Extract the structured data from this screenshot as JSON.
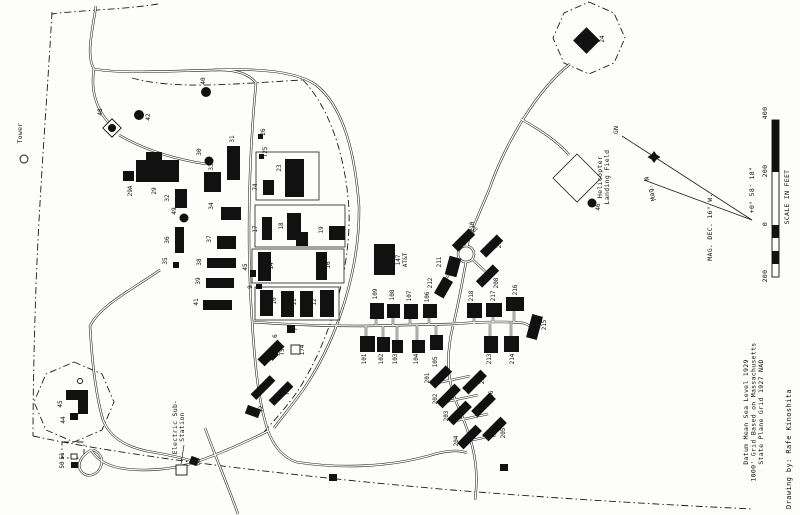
{
  "map": {
    "tower_label": "Tower",
    "att": {
      "number": "147",
      "name": "AT&T"
    },
    "helicopter": {
      "line1": "Helicopter",
      "line2": "Landing Field"
    },
    "substation": {
      "line1": "Electric Sub-",
      "line2": "Station"
    },
    "compass": {
      "grid_north": "GN",
      "magnetic_north": "Mag. N",
      "declination": "MAG. DEC. 16° W.",
      "grid_offset": "+0° 58' 18\""
    },
    "scale_bar": {
      "ticks": [
        "400",
        "200",
        "0",
        "200"
      ],
      "caption": "SCALE IN FEET"
    },
    "notes": {
      "datum1": "Datum Mean Sea Level 1929",
      "datum2": "1000' Grid Based on Massachusetts",
      "datum3": "State Plane Grid 1927 NAD",
      "credit": "Drawing by: Rafe Kinoshita"
    },
    "buildings": [
      {
        "n": "",
        "t": "circle",
        "x": 24,
        "y": 159,
        "r": 4
      },
      {
        "n": "40",
        "t": "dot",
        "x": 206,
        "y": 92,
        "r": 5,
        "lx": 205,
        "ly": 81
      },
      {
        "n": "42",
        "t": "dot",
        "x": 139,
        "y": 115,
        "r": 5,
        "lx": 150,
        "ly": 117
      },
      {
        "n": "",
        "t": "open",
        "x": 105.5,
        "y": 121.5,
        "w": 13,
        "h": 13,
        "rot": 45
      },
      {
        "n": "48",
        "t": "dot",
        "x": 112,
        "y": 128,
        "r": 4,
        "lx": 102,
        "ly": 112
      },
      {
        "n": "30",
        "t": "dot",
        "x": 209,
        "y": 161,
        "r": 4.5,
        "lx": 201,
        "ly": 152
      },
      {
        "n": "49",
        "t": "dot",
        "x": 184,
        "y": 218,
        "r": 4.5,
        "lx": 176,
        "ly": 211
      },
      {
        "n": "46",
        "t": "dot",
        "x": 592,
        "y": 203,
        "r": 4.5,
        "lx": 600,
        "ly": 207
      },
      {
        "n": "29A",
        "t": "rect",
        "x": 123,
        "y": 171,
        "w": 11,
        "h": 10,
        "lx": 132,
        "ly": 191
      },
      {
        "n": "",
        "t": "rect",
        "x": 146,
        "y": 152,
        "w": 16,
        "h": 10
      },
      {
        "n": "29",
        "t": "rect",
        "x": 136,
        "y": 160,
        "w": 43,
        "h": 22,
        "lx": 156,
        "ly": 191
      },
      {
        "n": "32",
        "t": "rect",
        "x": 175,
        "y": 189,
        "w": 12,
        "h": 19,
        "lx": 169,
        "ly": 198
      },
      {
        "n": "36",
        "t": "rect",
        "x": 175,
        "y": 227,
        "w": 9,
        "h": 26,
        "lx": 169,
        "ly": 240
      },
      {
        "n": "35",
        "t": "rect",
        "x": 173,
        "y": 262,
        "w": 6,
        "h": 6,
        "lx": 167,
        "ly": 261
      },
      {
        "n": "33",
        "t": "rect",
        "x": 204,
        "y": 172,
        "w": 17,
        "h": 20,
        "lx": 213,
        "ly": 167
      },
      {
        "n": "31",
        "t": "rect",
        "x": 227,
        "y": 146,
        "w": 13,
        "h": 34,
        "lx": 234,
        "ly": 139
      },
      {
        "n": "26",
        "t": "rect",
        "x": 258,
        "y": 134,
        "w": 5,
        "h": 5,
        "lx": 265,
        "ly": 132
      },
      {
        "n": "T25",
        "t": "rect",
        "x": 259,
        "y": 154,
        "w": 5,
        "h": 5,
        "lx": 267,
        "ly": 152
      },
      {
        "n": "74",
        "t": "rect",
        "x": 263,
        "y": 180,
        "w": 11,
        "h": 15,
        "lx": 257,
        "ly": 187
      },
      {
        "n": "23",
        "t": "rect",
        "x": 285,
        "y": 159,
        "w": 19,
        "h": 38,
        "lx": 281,
        "ly": 168
      },
      {
        "n": "34",
        "t": "rect",
        "x": 221,
        "y": 207,
        "w": 20,
        "h": 13,
        "lx": 213,
        "ly": 206
      },
      {
        "n": "37",
        "t": "rect",
        "x": 217,
        "y": 236,
        "w": 19,
        "h": 13,
        "lx": 211,
        "ly": 239
      },
      {
        "n": "38",
        "t": "rect",
        "x": 207,
        "y": 258,
        "w": 29,
        "h": 10,
        "lx": 201,
        "ly": 262
      },
      {
        "n": "39",
        "t": "rect",
        "x": 206,
        "y": 278,
        "w": 28,
        "h": 10,
        "lx": 200,
        "ly": 281
      },
      {
        "n": "41",
        "t": "rect",
        "x": 203,
        "y": 300,
        "w": 29,
        "h": 10,
        "lx": 198,
        "ly": 302
      },
      {
        "n": "17",
        "t": "rect",
        "x": 262,
        "y": 217,
        "w": 10,
        "h": 23,
        "lx": 257,
        "ly": 229
      },
      {
        "n": "",
        "t": "rect",
        "x": 296,
        "y": 232,
        "w": 12,
        "h": 14
      },
      {
        "n": "18",
        "t": "rect",
        "x": 287,
        "y": 213,
        "w": 14,
        "h": 27,
        "lx": 283,
        "ly": 226
      },
      {
        "n": "19",
        "t": "rect",
        "x": 329,
        "y": 226,
        "w": 16,
        "h": 14,
        "lx": 323,
        "ly": 230
      },
      {
        "n": "14",
        "t": "rect",
        "x": 258,
        "y": 252,
        "w": 13,
        "h": 29,
        "lx": 273,
        "ly": 266
      },
      {
        "n": "45",
        "t": "rect",
        "x": 250,
        "y": 270,
        "w": 6,
        "h": 7,
        "lx": 247,
        "ly": 267
      },
      {
        "n": "16",
        "t": "rect",
        "x": 316,
        "y": 252,
        "w": 11,
        "h": 28,
        "lx": 330,
        "ly": 265
      },
      {
        "n": "9",
        "t": "rect",
        "x": 256,
        "y": 284,
        "w": 6,
        "h": 5,
        "lx": 252,
        "ly": 287
      },
      {
        "n": "10",
        "t": "rect",
        "x": 260,
        "y": 290,
        "w": 13,
        "h": 26,
        "lx": 276,
        "ly": 301
      },
      {
        "n": "11",
        "t": "rect",
        "x": 281,
        "y": 291,
        "w": 13,
        "h": 26,
        "lx": 296,
        "ly": 302
      },
      {
        "n": "12",
        "t": "rect",
        "x": 300,
        "y": 291,
        "w": 13,
        "h": 26,
        "lx": 316,
        "ly": 302
      },
      {
        "n": "",
        "t": "rect",
        "x": 320,
        "y": 290,
        "w": 14,
        "h": 27
      },
      {
        "n": "6",
        "t": "rect",
        "x": 266,
        "y": 339,
        "w": 10,
        "h": 28,
        "rot": 45,
        "lx": 277,
        "ly": 336
      },
      {
        "n": "",
        "t": "rect",
        "x": 268,
        "y": 350,
        "w": 9,
        "h": 9,
        "rot": 45
      },
      {
        "n": "T5",
        "t": "label",
        "lx": 284,
        "ly": 352
      },
      {
        "n": "7",
        "t": "rect",
        "x": 287,
        "y": 325,
        "w": 8,
        "h": 8,
        "lx": 297,
        "ly": 329
      },
      {
        "n": "174",
        "t": "open",
        "x": 291,
        "y": 345,
        "w": 9,
        "h": 9,
        "lx": 304,
        "ly": 350
      },
      {
        "n": "T4",
        "t": "rect",
        "x": 259,
        "y": 374,
        "w": 8,
        "h": 27,
        "rot": 45,
        "lx": 269,
        "ly": 383
      },
      {
        "n": "T3",
        "t": "rect",
        "x": 277,
        "y": 380,
        "w": 8,
        "h": 27,
        "rot": 45,
        "lx": 289,
        "ly": 392
      },
      {
        "n": "T2",
        "t": "rect",
        "x": 246,
        "y": 407,
        "w": 14,
        "h": 9,
        "rot": 20,
        "lx": 263,
        "ly": 409
      },
      {
        "n": "",
        "t": "rect",
        "x": 374,
        "y": 244,
        "w": 21,
        "h": 31
      },
      {
        "n": "101",
        "t": "rect",
        "x": 360,
        "y": 336,
        "w": 15,
        "h": 16,
        "lx": 366,
        "ly": 359
      },
      {
        "n": "102",
        "t": "rect",
        "x": 377,
        "y": 337,
        "w": 13,
        "h": 15,
        "lx": 383,
        "ly": 359
      },
      {
        "n": "103",
        "t": "rect",
        "x": 392,
        "y": 340,
        "w": 11,
        "h": 13,
        "lx": 397,
        "ly": 359
      },
      {
        "n": "104",
        "t": "rect",
        "x": 412,
        "y": 340,
        "w": 13,
        "h": 13,
        "lx": 418,
        "ly": 359
      },
      {
        "n": "105",
        "t": "rect",
        "x": 430,
        "y": 335,
        "w": 13,
        "h": 15,
        "lx": 437,
        "ly": 362
      },
      {
        "n": "106",
        "t": "rect",
        "x": 423,
        "y": 304,
        "w": 14,
        "h": 14,
        "lx": 429,
        "ly": 297
      },
      {
        "n": "107",
        "t": "rect",
        "x": 404,
        "y": 304,
        "w": 14,
        "h": 15,
        "lx": 411,
        "ly": 296
      },
      {
        "n": "108",
        "t": "rect",
        "x": 387,
        "y": 304,
        "w": 13,
        "h": 14,
        "lx": 394,
        "ly": 295
      },
      {
        "n": "109",
        "t": "rect",
        "x": 370,
        "y": 303,
        "w": 14,
        "h": 16,
        "lx": 377,
        "ly": 294
      },
      {
        "n": "201",
        "t": "rect",
        "x": 436,
        "y": 365,
        "w": 9,
        "h": 24,
        "rot": 45,
        "lx": 429,
        "ly": 378
      },
      {
        "n": "202",
        "t": "rect",
        "x": 444,
        "y": 383,
        "w": 9,
        "h": 26,
        "rot": 45,
        "lx": 437,
        "ly": 399
      },
      {
        "n": "203",
        "t": "rect",
        "x": 455,
        "y": 400,
        "w": 9,
        "h": 26,
        "rot": 45,
        "lx": 448,
        "ly": 416
      },
      {
        "n": "204",
        "t": "rect",
        "x": 465,
        "y": 424,
        "w": 9,
        "h": 26,
        "rot": 45,
        "lx": 458,
        "ly": 441
      },
      {
        "n": "205",
        "t": "rect",
        "x": 490,
        "y": 416,
        "w": 9,
        "h": 26,
        "rot": 45,
        "lx": 505,
        "ly": 433
      },
      {
        "n": "206",
        "t": "rect",
        "x": 479,
        "y": 392,
        "w": 9,
        "h": 26,
        "rot": 45,
        "lx": 493,
        "ly": 396
      },
      {
        "n": "207",
        "t": "rect",
        "x": 470,
        "y": 369,
        "w": 9,
        "h": 26,
        "rot": 45,
        "lx": 484,
        "ly": 379
      },
      {
        "n": "208",
        "t": "rect",
        "x": 483,
        "y": 264,
        "w": 9,
        "h": 24,
        "rot": 45,
        "lx": 498,
        "ly": 283
      },
      {
        "n": "209",
        "t": "rect",
        "x": 487,
        "y": 234,
        "w": 9,
        "h": 24,
        "rot": 45,
        "lx": 501,
        "ly": 243
      },
      {
        "n": "210",
        "t": "rect",
        "x": 459,
        "y": 228,
        "w": 9,
        "h": 24,
        "rot": 45,
        "lx": 474,
        "ly": 227
      },
      {
        "n": "211",
        "t": "rect",
        "x": 447,
        "y": 257,
        "w": 12,
        "h": 19,
        "rot": 15,
        "lx": 441,
        "ly": 262
      },
      {
        "n": "212",
        "t": "rect",
        "x": 438,
        "y": 278,
        "w": 11,
        "h": 19,
        "rot": 30,
        "lx": 432,
        "ly": 283
      },
      {
        "n": "213",
        "t": "rect",
        "x": 484,
        "y": 336,
        "w": 14,
        "h": 17,
        "lx": 491,
        "ly": 359
      },
      {
        "n": "214",
        "t": "rect",
        "x": 504,
        "y": 336,
        "w": 15,
        "h": 16,
        "lx": 514,
        "ly": 359
      },
      {
        "n": "215",
        "t": "rect",
        "x": 529,
        "y": 315,
        "w": 11,
        "h": 24,
        "rot": 15,
        "lx": 546,
        "ly": 325
      },
      {
        "n": "216",
        "t": "rect",
        "x": 506,
        "y": 297,
        "w": 18,
        "h": 14,
        "lx": 517,
        "ly": 290
      },
      {
        "n": "217",
        "t": "rect",
        "x": 486,
        "y": 303,
        "w": 16,
        "h": 14,
        "lx": 495,
        "ly": 296
      },
      {
        "n": "218",
        "t": "rect",
        "x": 467,
        "y": 303,
        "w": 15,
        "h": 15,
        "lx": 473,
        "ly": 296
      },
      {
        "n": "24",
        "t": "rect",
        "x": 577,
        "y": 31,
        "w": 19,
        "h": 19,
        "rot": 45,
        "lx": 604,
        "ly": 39
      },
      {
        "n": "",
        "t": "circle",
        "x": 80,
        "y": 381,
        "r": 2.5
      },
      {
        "n": "",
        "t": "rect",
        "x": 78,
        "y": 398,
        "w": 10,
        "h": 16
      },
      {
        "n": "45",
        "t": "rect",
        "x": 66,
        "y": 390,
        "w": 22,
        "h": 10,
        "lx": 62,
        "ly": 404
      },
      {
        "n": "44",
        "t": "rect",
        "x": 70,
        "y": 413,
        "w": 8,
        "h": 7,
        "lx": 65,
        "ly": 420
      },
      {
        "n": "51",
        "t": "open",
        "x": 71,
        "y": 454,
        "w": 6,
        "h": 5,
        "lx": 64,
        "ly": 456
      },
      {
        "n": "50",
        "t": "rect",
        "x": 71,
        "y": 462,
        "w": 7,
        "h": 6,
        "lx": 64,
        "ly": 465
      },
      {
        "n": "60",
        "t": "rect",
        "x": 190,
        "y": 457,
        "w": 8,
        "h": 8,
        "rot": 20,
        "lx": 200,
        "ly": 462
      },
      {
        "n": "",
        "t": "open",
        "x": 176,
        "y": 465,
        "w": 11,
        "h": 10
      },
      {
        "n": "",
        "t": "rect",
        "x": 329,
        "y": 474,
        "w": 8,
        "h": 7
      },
      {
        "n": "",
        "t": "rect",
        "x": 500,
        "y": 464,
        "w": 8,
        "h": 7
      }
    ]
  }
}
